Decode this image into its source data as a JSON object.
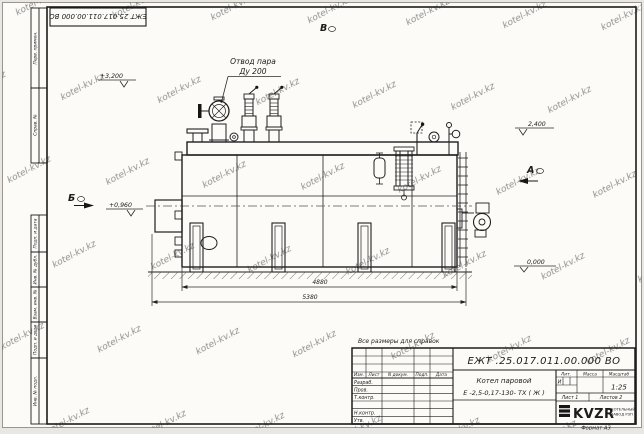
{
  "frame": {
    "top_stamp": "ЕЖТ 25.017.011.00.000  ВО",
    "format_note": "Формат А3",
    "watermark": "kotel-kv.kz",
    "side_labels": {
      "perv": "Перв. примен.",
      "sprav": "Справ. №",
      "podp1": "Подп. и дата",
      "inv_dubl": "Инв. № дубл.",
      "vzam": "Взам. инв. №",
      "podp2": "Подп. и дата",
      "inv_podl": "Инв. № подл."
    }
  },
  "drawing": {
    "callout": {
      "line1": "Отвод пара",
      "line2": "Ду 200"
    },
    "elevations": {
      "e3200": "+3,200",
      "e2400": "2,400",
      "e0960": "+0,960",
      "e0000": "0,000"
    },
    "views": {
      "b": "Б",
      "v": "В",
      "a": "А"
    },
    "dimensions": {
      "inner": "4880",
      "outer": "5380"
    }
  },
  "note": "Все размеры для справок",
  "title_block": {
    "designation": "ЕЖТ .25.017.011.00.000  ВО",
    "product_line1": "Котел паровой",
    "product_line2": "Е -2,5-0,17-130- ТХ ( Ж )",
    "col_izm": "Изм.",
    "col_list": "Лист",
    "col_doc": "N докум.",
    "col_podp": "Подп.",
    "col_data": "Дата",
    "row_razrab": "Разраб.",
    "row_prov": "Пров.",
    "row_tkontr": "Т.контр.",
    "row_nkontr": "Н.контр.",
    "row_utv": "Утв.",
    "lit_label": "Лит.",
    "lit_value": "И",
    "mass_label": "Масса",
    "scale_label": "Масштаб",
    "scale_value": "1:25",
    "sheet_label": "Лист 1",
    "sheets_label": "Листов 2",
    "logo_text": "KVZR",
    "company_line1": "КОТЕЛЬНЫЙ",
    "company_line2": "ЗАВОД РЗП"
  }
}
